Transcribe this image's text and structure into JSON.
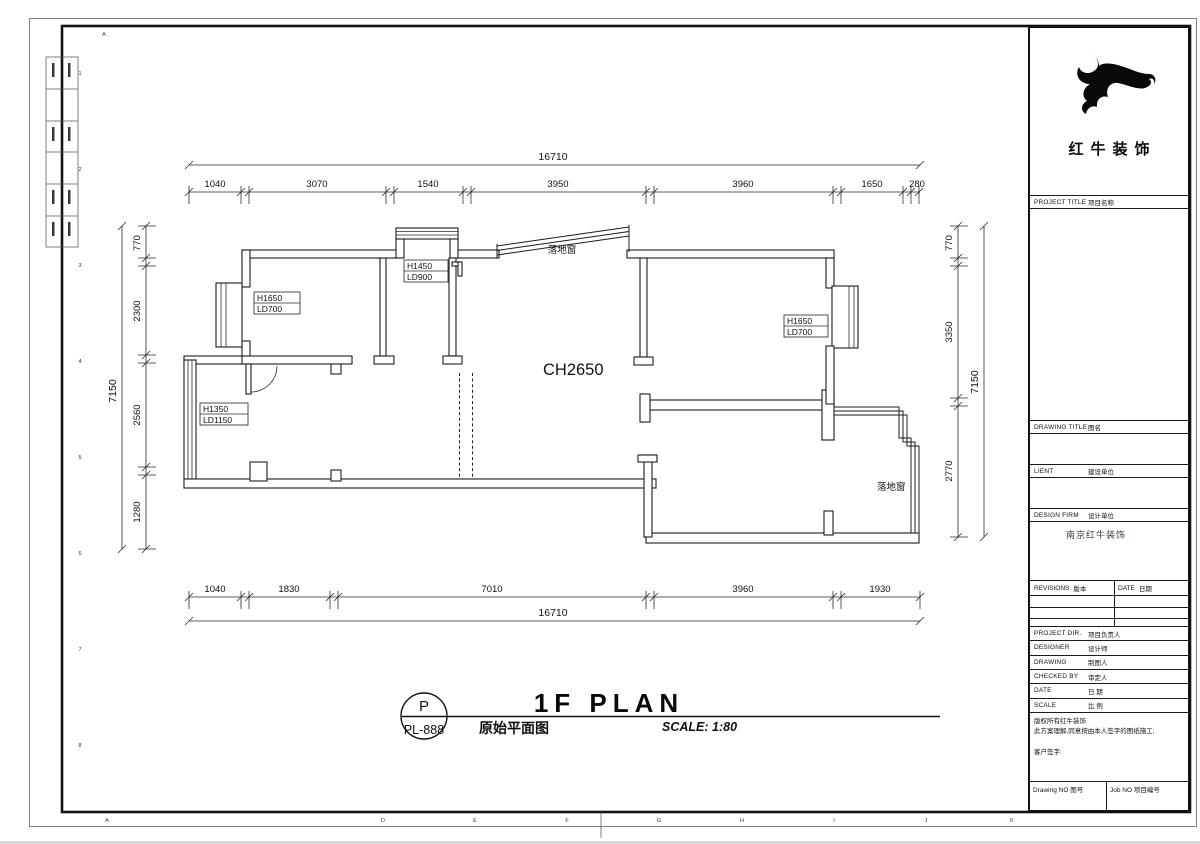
{
  "grid": {
    "top": [
      "A"
    ],
    "bottom": [
      "A",
      "D",
      "E",
      "F",
      "G",
      "H",
      "I",
      "J",
      "K"
    ],
    "left_rows": [
      "1",
      "2",
      "3",
      "4",
      "5",
      "6",
      "7",
      "8"
    ],
    "right_rows": [
      "1",
      "2",
      "3",
      "4",
      "5",
      "6",
      "7",
      "8"
    ]
  },
  "dims": {
    "top": {
      "total": "16710",
      "segs": [
        "1040",
        "3070",
        "1540",
        "3950",
        "3960",
        "1650",
        "280"
      ]
    },
    "bottom": {
      "total": "16710",
      "segs": [
        "1040",
        "1830",
        "7010",
        "3960",
        "1930"
      ]
    },
    "left": {
      "total": "7150",
      "segs": [
        "770",
        "2300",
        "2560",
        "1280"
      ]
    },
    "right": {
      "total": "7150",
      "segs": [
        "770",
        "3350",
        "2770"
      ]
    }
  },
  "plan": {
    "ceiling_height": "CH2650",
    "floor_window_top": "落地窗",
    "floor_window_right": "落地窗",
    "tags": {
      "left_top": {
        "h": "H1650",
        "ld": "LD700"
      },
      "mid_top": {
        "h": "H1450",
        "ld": "LD900"
      },
      "right": {
        "h": "H1650",
        "ld": "LD700"
      },
      "left_bottom": {
        "h": "H1350",
        "ld": "LD1150"
      }
    }
  },
  "title": {
    "badge_top": "P",
    "badge_no": "PL-888",
    "main": "1F PLAN",
    "cn": "原始平面图",
    "scale": "SCALE: 1:80"
  },
  "tb": {
    "brand": "红牛装饰",
    "project_title": {
      "en": "PROJECT TITLE",
      "cn": "项目名称"
    },
    "drawing_title": {
      "en": "DRAWING TITLE",
      "cn": "图名"
    },
    "client": {
      "en": "LIENT",
      "cn": "建设单位"
    },
    "design_firm": {
      "en": "DESIGN FIRM",
      "cn": "设计单位",
      "value": "南京红牛装饰"
    },
    "revisions": {
      "en": "REVISIONS",
      "cn": "版本"
    },
    "date_col": {
      "en": "DATE",
      "cn": "日期"
    },
    "fields": [
      {
        "en": "PROJECT DIR.",
        "cn": "项目负责人"
      },
      {
        "en": "DESIGNER",
        "cn": "设计师"
      },
      {
        "en": "DRAWING",
        "cn": "制图人"
      },
      {
        "en": "CHECKED BY",
        "cn": "审定人"
      },
      {
        "en": "DATE",
        "cn": "日 期"
      },
      {
        "en": "SCALE",
        "cn": "比 例"
      }
    ],
    "notes": [
      "版权所有红牛装饰",
      "此方案理解,同意按由本人签字的图纸施工:",
      "客户签字:"
    ],
    "drawing_no": {
      "en": "Drawing NO",
      "cn": "图号"
    },
    "job_no": {
      "en": "Job NO",
      "cn": "项目编号"
    }
  }
}
